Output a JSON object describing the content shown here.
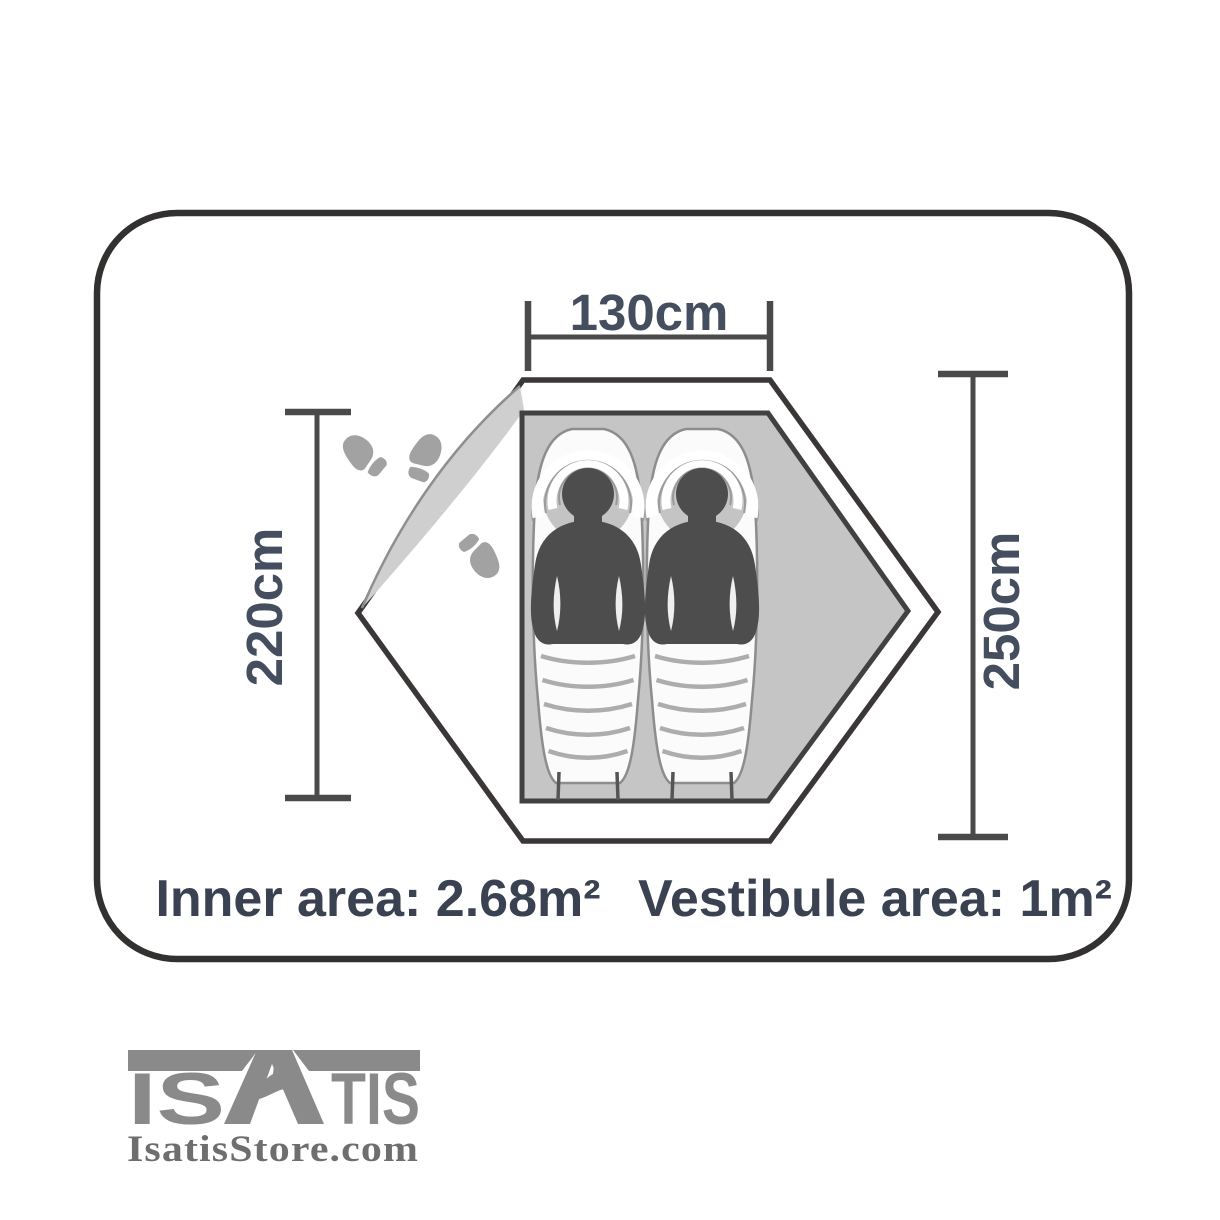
{
  "diagram": {
    "type": "tent-floorplan",
    "dimensions": {
      "width_label": "130cm",
      "inner_length_label": "220cm",
      "outer_length_label": "250cm"
    },
    "area_caption": {
      "inner": "Inner area: 2.68m²",
      "vestibule": "Vestibule area: 1m²"
    },
    "icons": {
      "sleeper": "sleeping-person-in-sleeping-bag-icon",
      "footprints": "footprint-icon",
      "door": "door-flap-open-icon"
    },
    "occupants": 2,
    "footprint_count": 3
  },
  "branding": {
    "logo_word": "ISATIS",
    "logo_segment_left": "IS",
    "logo_segment_right": "TIS",
    "logo_icon": "fox-icon",
    "website": "IsatisStore.com"
  },
  "colors": {
    "outline_dark": "#333130",
    "dimension_text": "#454e5e",
    "caption_text": "#3a4150",
    "floor_gray": "#c5c5c5",
    "figure_dark": "#4d4d4d",
    "accent_gray": "#a2a2a2",
    "logo_gray": "#8a8a8a",
    "website_gray": "#6e6e6e",
    "background": "#ffffff"
  }
}
